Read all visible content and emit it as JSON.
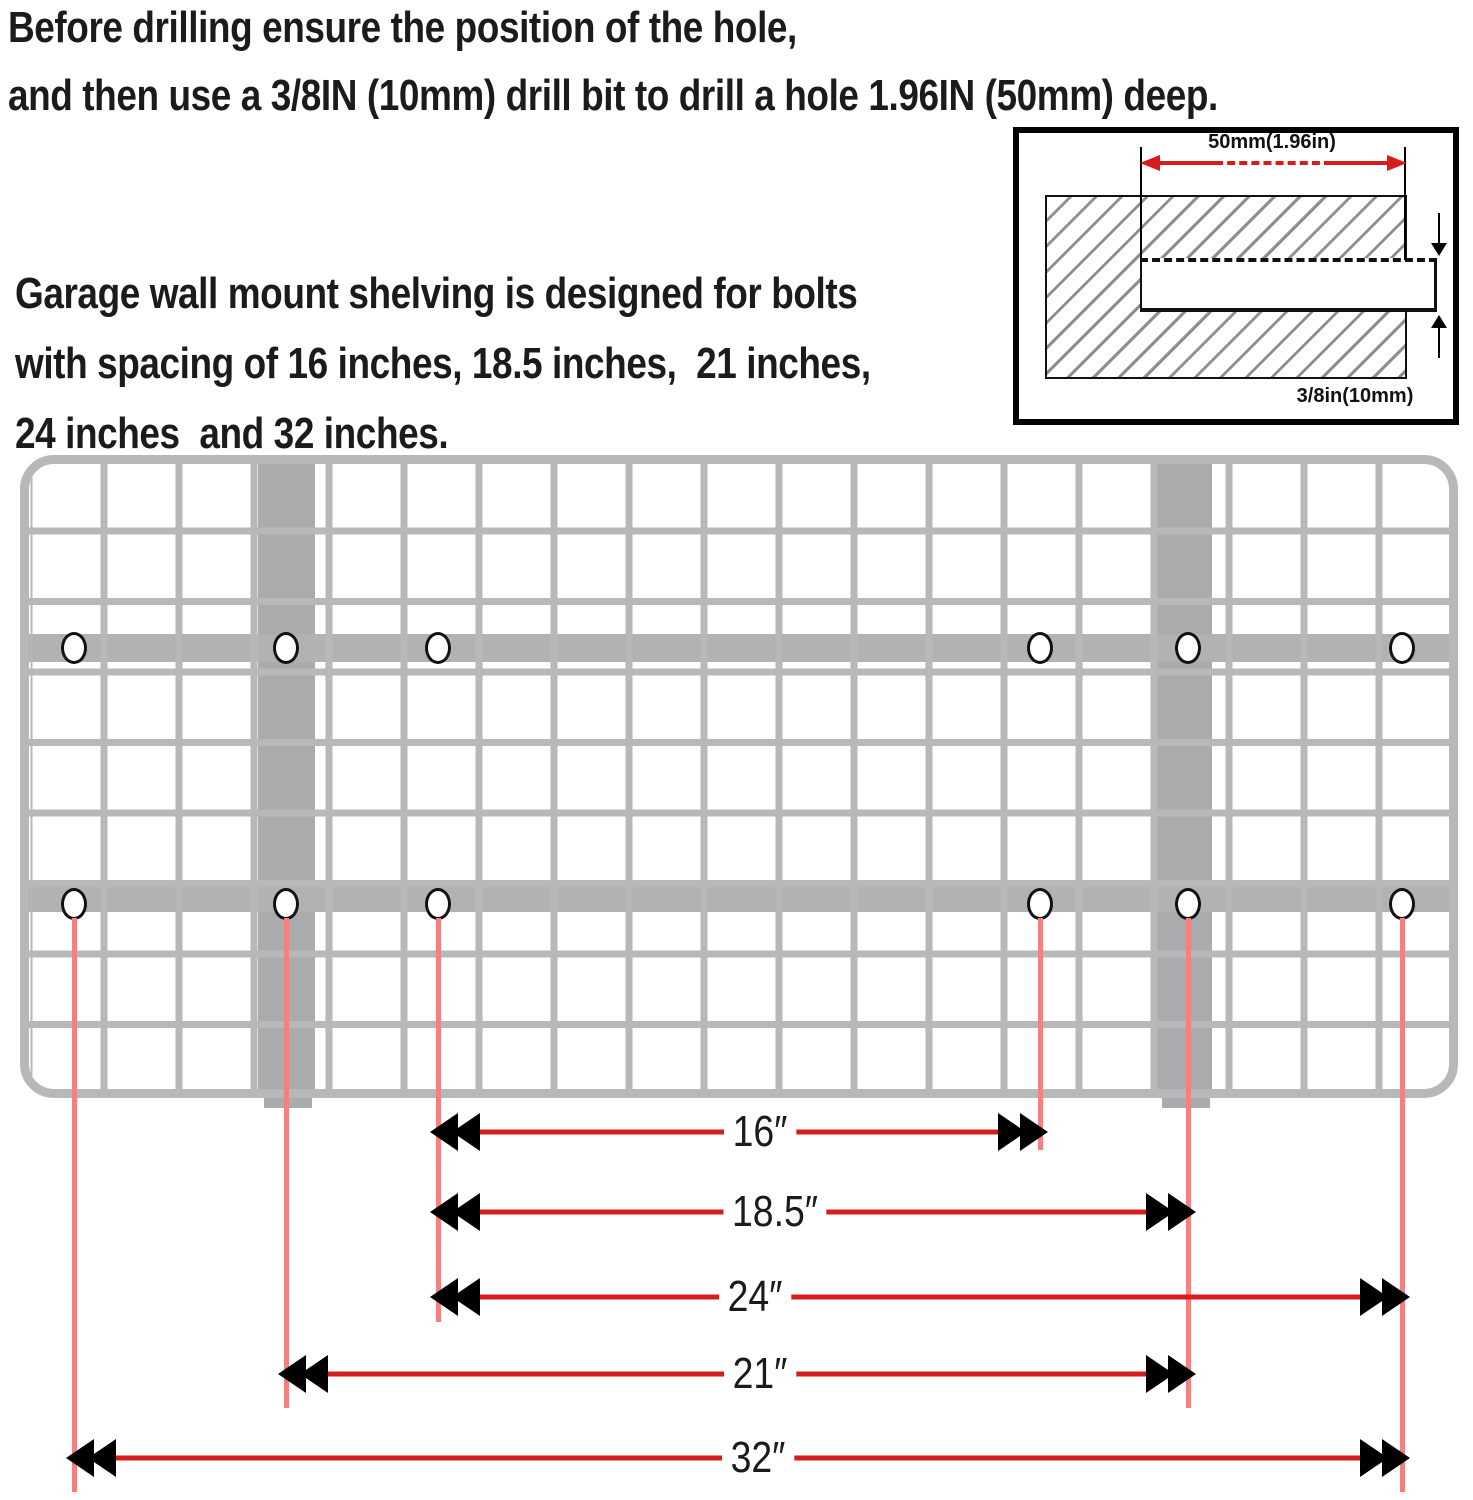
{
  "intro": {
    "line1": "Before drilling ensure the position of the hole,",
    "line2": "and then use a 3/8IN (10mm) drill bit to drill a hole 1.96IN (50mm) deep."
  },
  "note": {
    "line1": "Garage wall mount shelving is designed for bolts",
    "line2": "with spacing of 16 inches, 18.5 inches,  21 inches,",
    "line3": "24 inches  and 32 inches."
  },
  "inset": {
    "depth_label": "50mm(1.96in)",
    "bit_label": "3/8in(10mm)"
  },
  "dims": [
    {
      "label": "16″"
    },
    {
      "label": "18.5″"
    },
    {
      "label": "24″"
    },
    {
      "label": "21″"
    },
    {
      "label": "32″"
    }
  ],
  "colors": {
    "dimension_red": "#d61c1c",
    "extension_red": "#f58080",
    "grid_gray": "#b6b8ba",
    "rail_gray": "#b0b2b4",
    "bracket_gray": "#a9abad",
    "text_black": "#1b1b1b"
  }
}
